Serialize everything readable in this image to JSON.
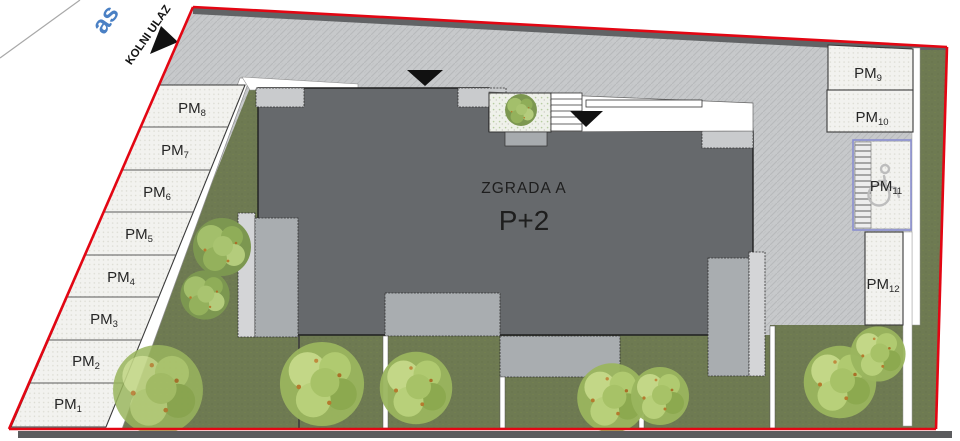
{
  "plan": {
    "street_label": "as",
    "entrance_label": "KOLNI ULAZ",
    "building": {
      "name": "ZGRADA A",
      "floors": "P+2"
    },
    "parking_left": [
      {
        "label": "PM",
        "num": "8"
      },
      {
        "label": "PM",
        "num": "7"
      },
      {
        "label": "PM",
        "num": "6"
      },
      {
        "label": "PM",
        "num": "5"
      },
      {
        "label": "PM",
        "num": "4"
      },
      {
        "label": "PM",
        "num": "3"
      },
      {
        "label": "PM",
        "num": "2"
      },
      {
        "label": "PM",
        "num": "1"
      }
    ],
    "parking_right": [
      {
        "label": "PM",
        "num": "9"
      },
      {
        "label": "PM",
        "num": "10"
      },
      {
        "label": "PM",
        "num": "11",
        "accessible": "true"
      },
      {
        "label": "PM",
        "num": "12"
      }
    ],
    "colors": {
      "boundary_red": "#e30613",
      "building_gray": "#66696c",
      "lawn_green": "#6e7a52",
      "asphalt_gray": "#c7c9cb",
      "street_blue": "#4a80c4",
      "accessible_outline_blue": "#8a8fd0"
    }
  }
}
